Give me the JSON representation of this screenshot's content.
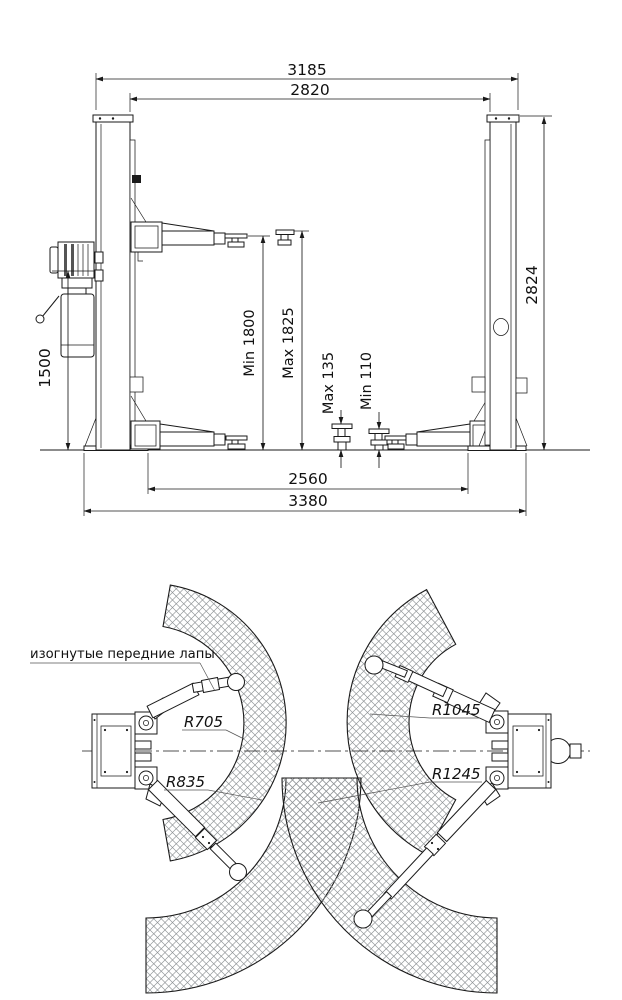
{
  "drawing": {
    "title": "Two-post car lift dimensional drawing",
    "front_view": {
      "dim_width_overall_top": "3185",
      "dim_width_between_posts": "2820",
      "dim_post_height": "2824",
      "dim_power_unit_height": "1500",
      "dim_lift_height_min": "Min 1800",
      "dim_lift_height_max": "Max 1825",
      "dim_pad_height_max": "Max 135",
      "dim_pad_height_min": "Min 110",
      "dim_width_between_bases": "2560",
      "dim_width_overall_base": "3380"
    },
    "plan_view": {
      "note_front_arms": "изогнутые передние лапы",
      "radius_front_arm_min": "R705",
      "radius_front_arm_max": "R835",
      "radius_rear_arm_min": "R1045",
      "radius_rear_arm_max": "R1245"
    }
  }
}
